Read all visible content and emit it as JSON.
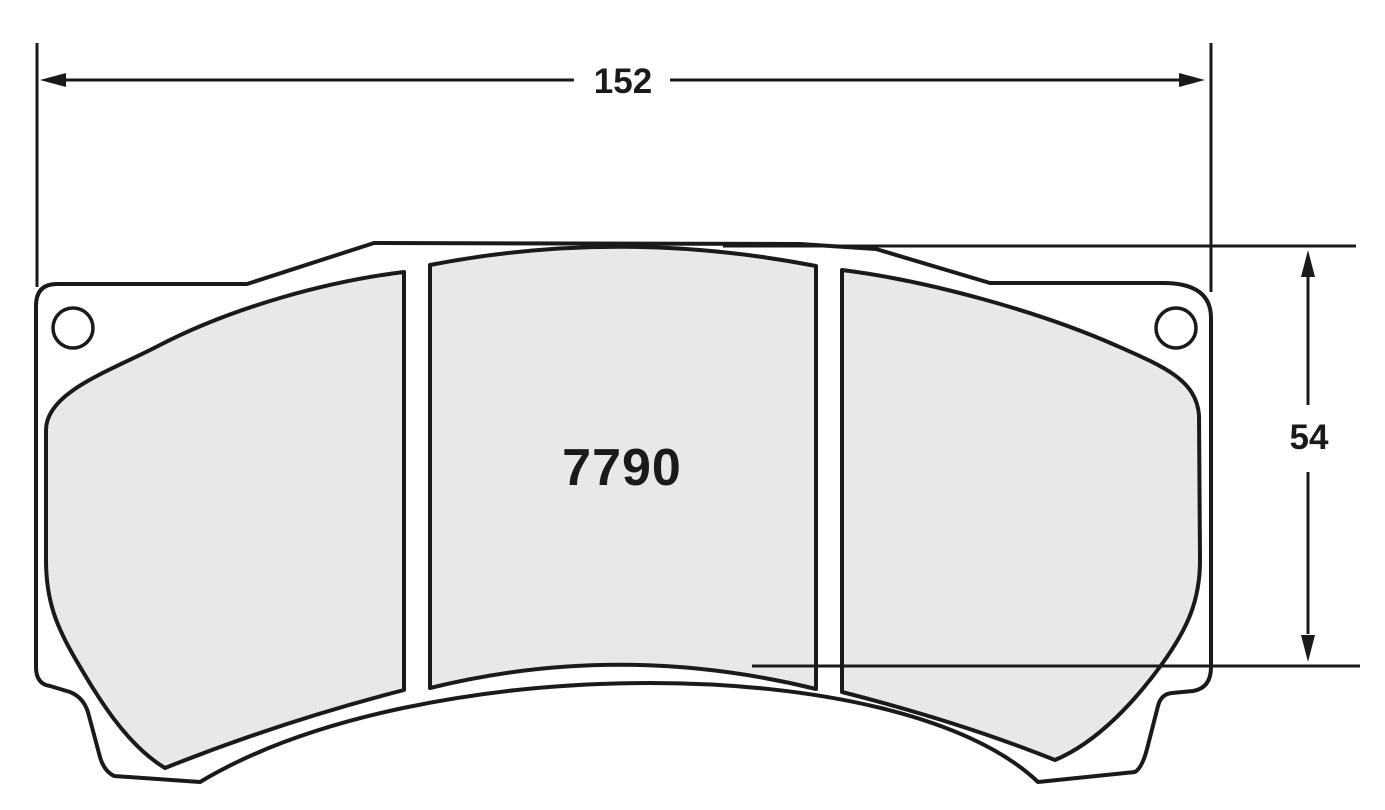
{
  "drawing": {
    "part_number": "7790",
    "dimensions": {
      "width": "152",
      "height": "54"
    },
    "colors": {
      "line": "#1a1a1a",
      "pad_fill": "#e7e8e9",
      "plate_fill": "#ffffff",
      "background": "#ffffff"
    }
  }
}
